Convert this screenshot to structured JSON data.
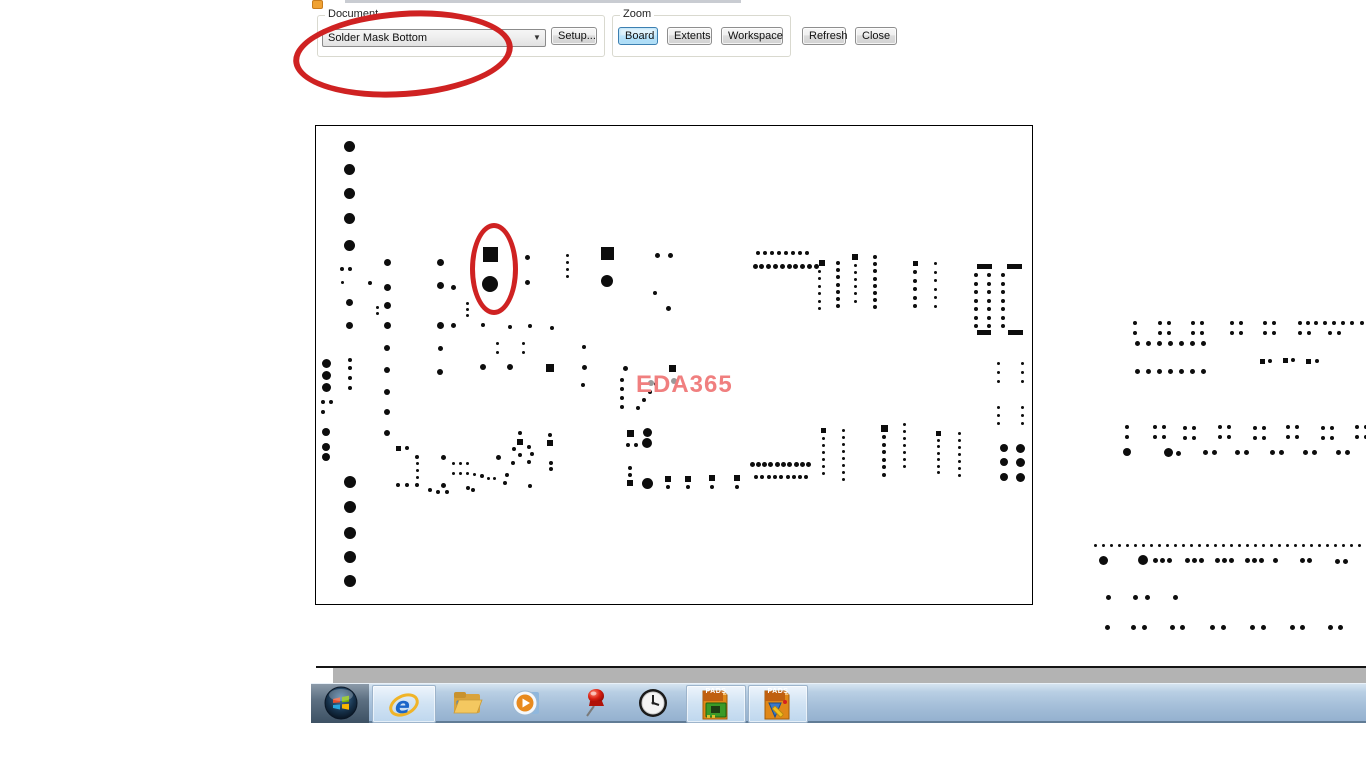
{
  "toolbar": {
    "document_group": {
      "label": "Document",
      "combo_value": "Solder Mask Bottom",
      "setup_label": "Setup..."
    },
    "zoom_group": {
      "label": "Zoom",
      "buttons": [
        {
          "label": "Board",
          "active": true
        },
        {
          "label": "Extents",
          "active": false
        },
        {
          "label": "Workspace",
          "active": false
        }
      ]
    },
    "refresh_label": "Refresh",
    "close_label": "Close"
  },
  "annotations": {
    "color": "#cf2222",
    "note": "hand-drawn red ellipse over Document dropdown and over one pad pair on board"
  },
  "board": {
    "watermark": "EDA365",
    "watermark_color": "#f07f7f",
    "pad_color": "#0d0d0d"
  },
  "taskbar": {
    "pads_label": "PADS",
    "icons": [
      "start-orb",
      "internet-explorer",
      "windows-explorer",
      "media-player",
      "pushpin",
      "clock",
      "pads-layout",
      "pads-logic"
    ]
  },
  "pcb": {
    "singles": [
      [
        349,
        146,
        11
      ],
      [
        349,
        169,
        11
      ],
      [
        349,
        193,
        11
      ],
      [
        349,
        218,
        11
      ],
      [
        349,
        245,
        11
      ],
      [
        342,
        269,
        4
      ],
      [
        350,
        269,
        4
      ],
      [
        342,
        282,
        3
      ],
      [
        370,
        283,
        4
      ],
      [
        377,
        307,
        3
      ],
      [
        377,
        313,
        3
      ],
      [
        349,
        302,
        7
      ],
      [
        349,
        325,
        7
      ],
      [
        387,
        262,
        7
      ],
      [
        387,
        287,
        7
      ],
      [
        387,
        305,
        7
      ],
      [
        387,
        325,
        7
      ],
      [
        387,
        348,
        6
      ],
      [
        387,
        370,
        6
      ],
      [
        387,
        392,
        6
      ],
      [
        387,
        412,
        6
      ],
      [
        387,
        433,
        6
      ],
      [
        440,
        262,
        7
      ],
      [
        440,
        285,
        7
      ],
      [
        453,
        287,
        5
      ],
      [
        440,
        325,
        7
      ],
      [
        453,
        325,
        5
      ],
      [
        440,
        348,
        5
      ],
      [
        440,
        372,
        6
      ],
      [
        490,
        284,
        16
      ],
      [
        527,
        257,
        5
      ],
      [
        527,
        282,
        5
      ],
      [
        607,
        281,
        12
      ],
      [
        657,
        255,
        5
      ],
      [
        670,
        255,
        5
      ],
      [
        655,
        293,
        4
      ],
      [
        668,
        308,
        5
      ],
      [
        483,
        325,
        4
      ],
      [
        510,
        327,
        4
      ],
      [
        530,
        326,
        4
      ],
      [
        552,
        328,
        4
      ],
      [
        497,
        343,
        3
      ],
      [
        497,
        352,
        3
      ],
      [
        523,
        343,
        3
      ],
      [
        523,
        352,
        3
      ],
      [
        584,
        347,
        4
      ],
      [
        584,
        367,
        5
      ],
      [
        583,
        385,
        4
      ],
      [
        483,
        367,
        6
      ],
      [
        510,
        367,
        6
      ],
      [
        625,
        368,
        5
      ],
      [
        638,
        408,
        4
      ],
      [
        644,
        400,
        4
      ],
      [
        650,
        392,
        4
      ],
      [
        656,
        384,
        4
      ],
      [
        520,
        433,
        4
      ],
      [
        514,
        449,
        4
      ],
      [
        529,
        447,
        4
      ],
      [
        520,
        455,
        4
      ],
      [
        532,
        454,
        4
      ],
      [
        513,
        463,
        4
      ],
      [
        529,
        462,
        4
      ],
      [
        550,
        435,
        4
      ],
      [
        551,
        463,
        4
      ],
      [
        551,
        469,
        4
      ],
      [
        507,
        475,
        4
      ],
      [
        505,
        483,
        4
      ],
      [
        530,
        486,
        4
      ],
      [
        647,
        432,
        9
      ],
      [
        628,
        445,
        4
      ],
      [
        636,
        445,
        4
      ],
      [
        647,
        443,
        10
      ],
      [
        630,
        468,
        4
      ],
      [
        630,
        475,
        4
      ],
      [
        647,
        483,
        11
      ],
      [
        668,
        487,
        4
      ],
      [
        688,
        487,
        4
      ],
      [
        712,
        487,
        4
      ],
      [
        737,
        487,
        4
      ],
      [
        407,
        448,
        4
      ],
      [
        417,
        457,
        4
      ],
      [
        398,
        485,
        4
      ],
      [
        407,
        485,
        4
      ],
      [
        417,
        485,
        4
      ],
      [
        443,
        457,
        5
      ],
      [
        443,
        485,
        5
      ],
      [
        498,
        457,
        5
      ],
      [
        453,
        463,
        3
      ],
      [
        460,
        463,
        3
      ],
      [
        467,
        463,
        3
      ],
      [
        453,
        473,
        3
      ],
      [
        460,
        473,
        3
      ],
      [
        467,
        473,
        3
      ],
      [
        474,
        474,
        3
      ],
      [
        482,
        476,
        4
      ],
      [
        488,
        478,
        3
      ],
      [
        494,
        478,
        3
      ],
      [
        430,
        490,
        4
      ],
      [
        438,
        492,
        4
      ],
      [
        447,
        492,
        4
      ],
      [
        468,
        488,
        4
      ],
      [
        473,
        490,
        4
      ],
      [
        326,
        363,
        9
      ],
      [
        326,
        375,
        9
      ],
      [
        326,
        387,
        9
      ],
      [
        350,
        360,
        4
      ],
      [
        350,
        368,
        4
      ],
      [
        350,
        378,
        4
      ],
      [
        350,
        388,
        4
      ],
      [
        323,
        402,
        4
      ],
      [
        331,
        402,
        4
      ],
      [
        323,
        412,
        4
      ],
      [
        326,
        432,
        8
      ],
      [
        326,
        447,
        8
      ],
      [
        326,
        457,
        8
      ],
      [
        350,
        482,
        12
      ],
      [
        350,
        507,
        12
      ],
      [
        350,
        533,
        12
      ],
      [
        350,
        557,
        12
      ],
      [
        350,
        581,
        12
      ],
      [
        935,
        263,
        3
      ],
      [
        1004,
        448,
        8
      ],
      [
        1020,
        448,
        9
      ],
      [
        1004,
        462,
        8
      ],
      [
        1020,
        462,
        9
      ],
      [
        1004,
        477,
        8
      ],
      [
        1020,
        477,
        9
      ],
      [
        1135,
        323,
        4
      ],
      [
        1362,
        323,
        4
      ],
      [
        1135,
        333,
        4
      ],
      [
        1270,
        361,
        4
      ],
      [
        1293,
        360,
        4
      ],
      [
        1317,
        361,
        4
      ],
      [
        1127,
        427,
        4
      ],
      [
        1127,
        437,
        4
      ],
      [
        1127,
        452,
        8
      ],
      [
        1168,
        452,
        9
      ],
      [
        1178,
        453,
        5
      ],
      [
        1103,
        560,
        9
      ],
      [
        1143,
        560,
        10
      ],
      [
        1275,
        560,
        5
      ],
      [
        1108,
        597,
        5
      ],
      [
        1135,
        597,
        5
      ],
      [
        1147,
        597,
        5
      ],
      [
        1175,
        597,
        5
      ],
      [
        1107,
        627,
        5
      ]
    ],
    "squares": [
      [
        490,
        254,
        15
      ],
      [
        607,
        253,
        13
      ],
      [
        672,
        368,
        7
      ],
      [
        550,
        368,
        8
      ],
      [
        520,
        442,
        6
      ],
      [
        550,
        443,
        6
      ],
      [
        630,
        433,
        7
      ],
      [
        630,
        483,
        6
      ],
      [
        668,
        479,
        6
      ],
      [
        688,
        479,
        6
      ],
      [
        712,
        478,
        6
      ],
      [
        737,
        478,
        6
      ],
      [
        398,
        448,
        5
      ],
      [
        822,
        263,
        6
      ],
      [
        855,
        257,
        6
      ],
      [
        915,
        263,
        5
      ],
      [
        823,
        430,
        5
      ],
      [
        884,
        428,
        7
      ],
      [
        938,
        433,
        5
      ],
      [
        1262,
        361,
        5
      ],
      [
        1285,
        360,
        5
      ],
      [
        1308,
        361,
        5
      ]
    ],
    "rows": [
      [
        758,
        253,
        8,
        7,
        4
      ],
      [
        755,
        266,
        10,
        6.8,
        5
      ],
      [
        752,
        464,
        10,
        6.3,
        5
      ],
      [
        756,
        477,
        9,
        6.3,
        4
      ],
      [
        1160,
        323,
        2,
        9,
        4
      ],
      [
        1193,
        323,
        2,
        9,
        4
      ],
      [
        1232,
        323,
        2,
        9,
        4
      ],
      [
        1265,
        323,
        2,
        9,
        4
      ],
      [
        1300,
        323,
        3,
        8,
        4
      ],
      [
        1325,
        323,
        2,
        9,
        4
      ],
      [
        1343,
        323,
        2,
        9,
        4
      ],
      [
        1160,
        333,
        2,
        9,
        4
      ],
      [
        1193,
        333,
        2,
        9,
        4
      ],
      [
        1232,
        333,
        2,
        9,
        4
      ],
      [
        1265,
        333,
        2,
        9,
        4
      ],
      [
        1300,
        333,
        2,
        9,
        4
      ],
      [
        1330,
        333,
        2,
        9,
        4
      ],
      [
        1137,
        343,
        7,
        11,
        5
      ],
      [
        1137,
        371,
        7,
        11,
        5
      ],
      [
        1155,
        427,
        2,
        9,
        4
      ],
      [
        1185,
        428,
        2,
        9,
        4
      ],
      [
        1220,
        427,
        2,
        9,
        4
      ],
      [
        1255,
        428,
        2,
        9,
        4
      ],
      [
        1288,
        427,
        2,
        9,
        4
      ],
      [
        1323,
        428,
        2,
        9,
        4
      ],
      [
        1357,
        427,
        2,
        9,
        4
      ],
      [
        1155,
        437,
        2,
        9,
        4
      ],
      [
        1185,
        438,
        2,
        9,
        4
      ],
      [
        1220,
        437,
        2,
        9,
        4
      ],
      [
        1255,
        438,
        2,
        9,
        4
      ],
      [
        1288,
        437,
        2,
        9,
        4
      ],
      [
        1323,
        438,
        2,
        9,
        4
      ],
      [
        1357,
        437,
        2,
        9,
        4
      ],
      [
        1205,
        452,
        2,
        9,
        5
      ],
      [
        1237,
        452,
        2,
        9,
        5
      ],
      [
        1272,
        452,
        2,
        9,
        5
      ],
      [
        1305,
        452,
        2,
        9,
        5
      ],
      [
        1338,
        452,
        2,
        9,
        5
      ],
      [
        1095,
        545,
        34,
        8,
        3
      ],
      [
        1155,
        560,
        3,
        7,
        5
      ],
      [
        1187,
        560,
        3,
        7,
        5
      ],
      [
        1217,
        560,
        3,
        7,
        5
      ],
      [
        1247,
        560,
        3,
        7,
        5
      ],
      [
        1302,
        560,
        2,
        7,
        5
      ],
      [
        1337,
        561,
        2,
        8,
        5
      ],
      [
        1133,
        627,
        2,
        11,
        5
      ],
      [
        1172,
        627,
        2,
        10,
        5
      ],
      [
        1212,
        627,
        2,
        11,
        5
      ],
      [
        1252,
        627,
        2,
        11,
        5
      ],
      [
        1292,
        627,
        2,
        10,
        5
      ],
      [
        1330,
        627,
        2,
        10,
        5
      ]
    ],
    "cols": [
      [
        567,
        255,
        4,
        7,
        3
      ],
      [
        819,
        271,
        6,
        7.5,
        3
      ],
      [
        838,
        263,
        7,
        7.2,
        4
      ],
      [
        855,
        265,
        6,
        7.2,
        3
      ],
      [
        875,
        257,
        8,
        7.2,
        4
      ],
      [
        915,
        272,
        5,
        8.5,
        4
      ],
      [
        935,
        272,
        5,
        8.5,
        3
      ],
      [
        976,
        275,
        7,
        8.5,
        4
      ],
      [
        989,
        275,
        7,
        8.5,
        4
      ],
      [
        1003,
        275,
        7,
        8.5,
        4
      ],
      [
        998,
        363,
        3,
        9,
        3
      ],
      [
        1022,
        363,
        3,
        9,
        3
      ],
      [
        998,
        407,
        3,
        8,
        3
      ],
      [
        1022,
        407,
        3,
        8,
        3
      ],
      [
        823,
        438,
        6,
        7,
        3
      ],
      [
        843,
        430,
        8,
        7,
        3
      ],
      [
        884,
        437,
        6,
        7.5,
        4
      ],
      [
        904,
        424,
        7,
        7,
        3
      ],
      [
        938,
        440,
        6,
        6.5,
        3
      ],
      [
        959,
        433,
        7,
        7,
        3
      ],
      [
        417,
        463,
        3,
        7,
        3
      ],
      [
        467,
        303,
        3,
        6,
        3
      ],
      [
        622,
        380,
        4,
        9,
        4
      ]
    ],
    "bars": [
      [
        977,
        264,
        15,
        5
      ],
      [
        1007,
        264,
        15,
        5
      ],
      [
        977,
        330,
        14,
        5
      ],
      [
        1008,
        330,
        15,
        5
      ]
    ],
    "grays": [
      [
        651,
        383,
        6
      ],
      [
        674,
        381,
        6
      ]
    ]
  }
}
